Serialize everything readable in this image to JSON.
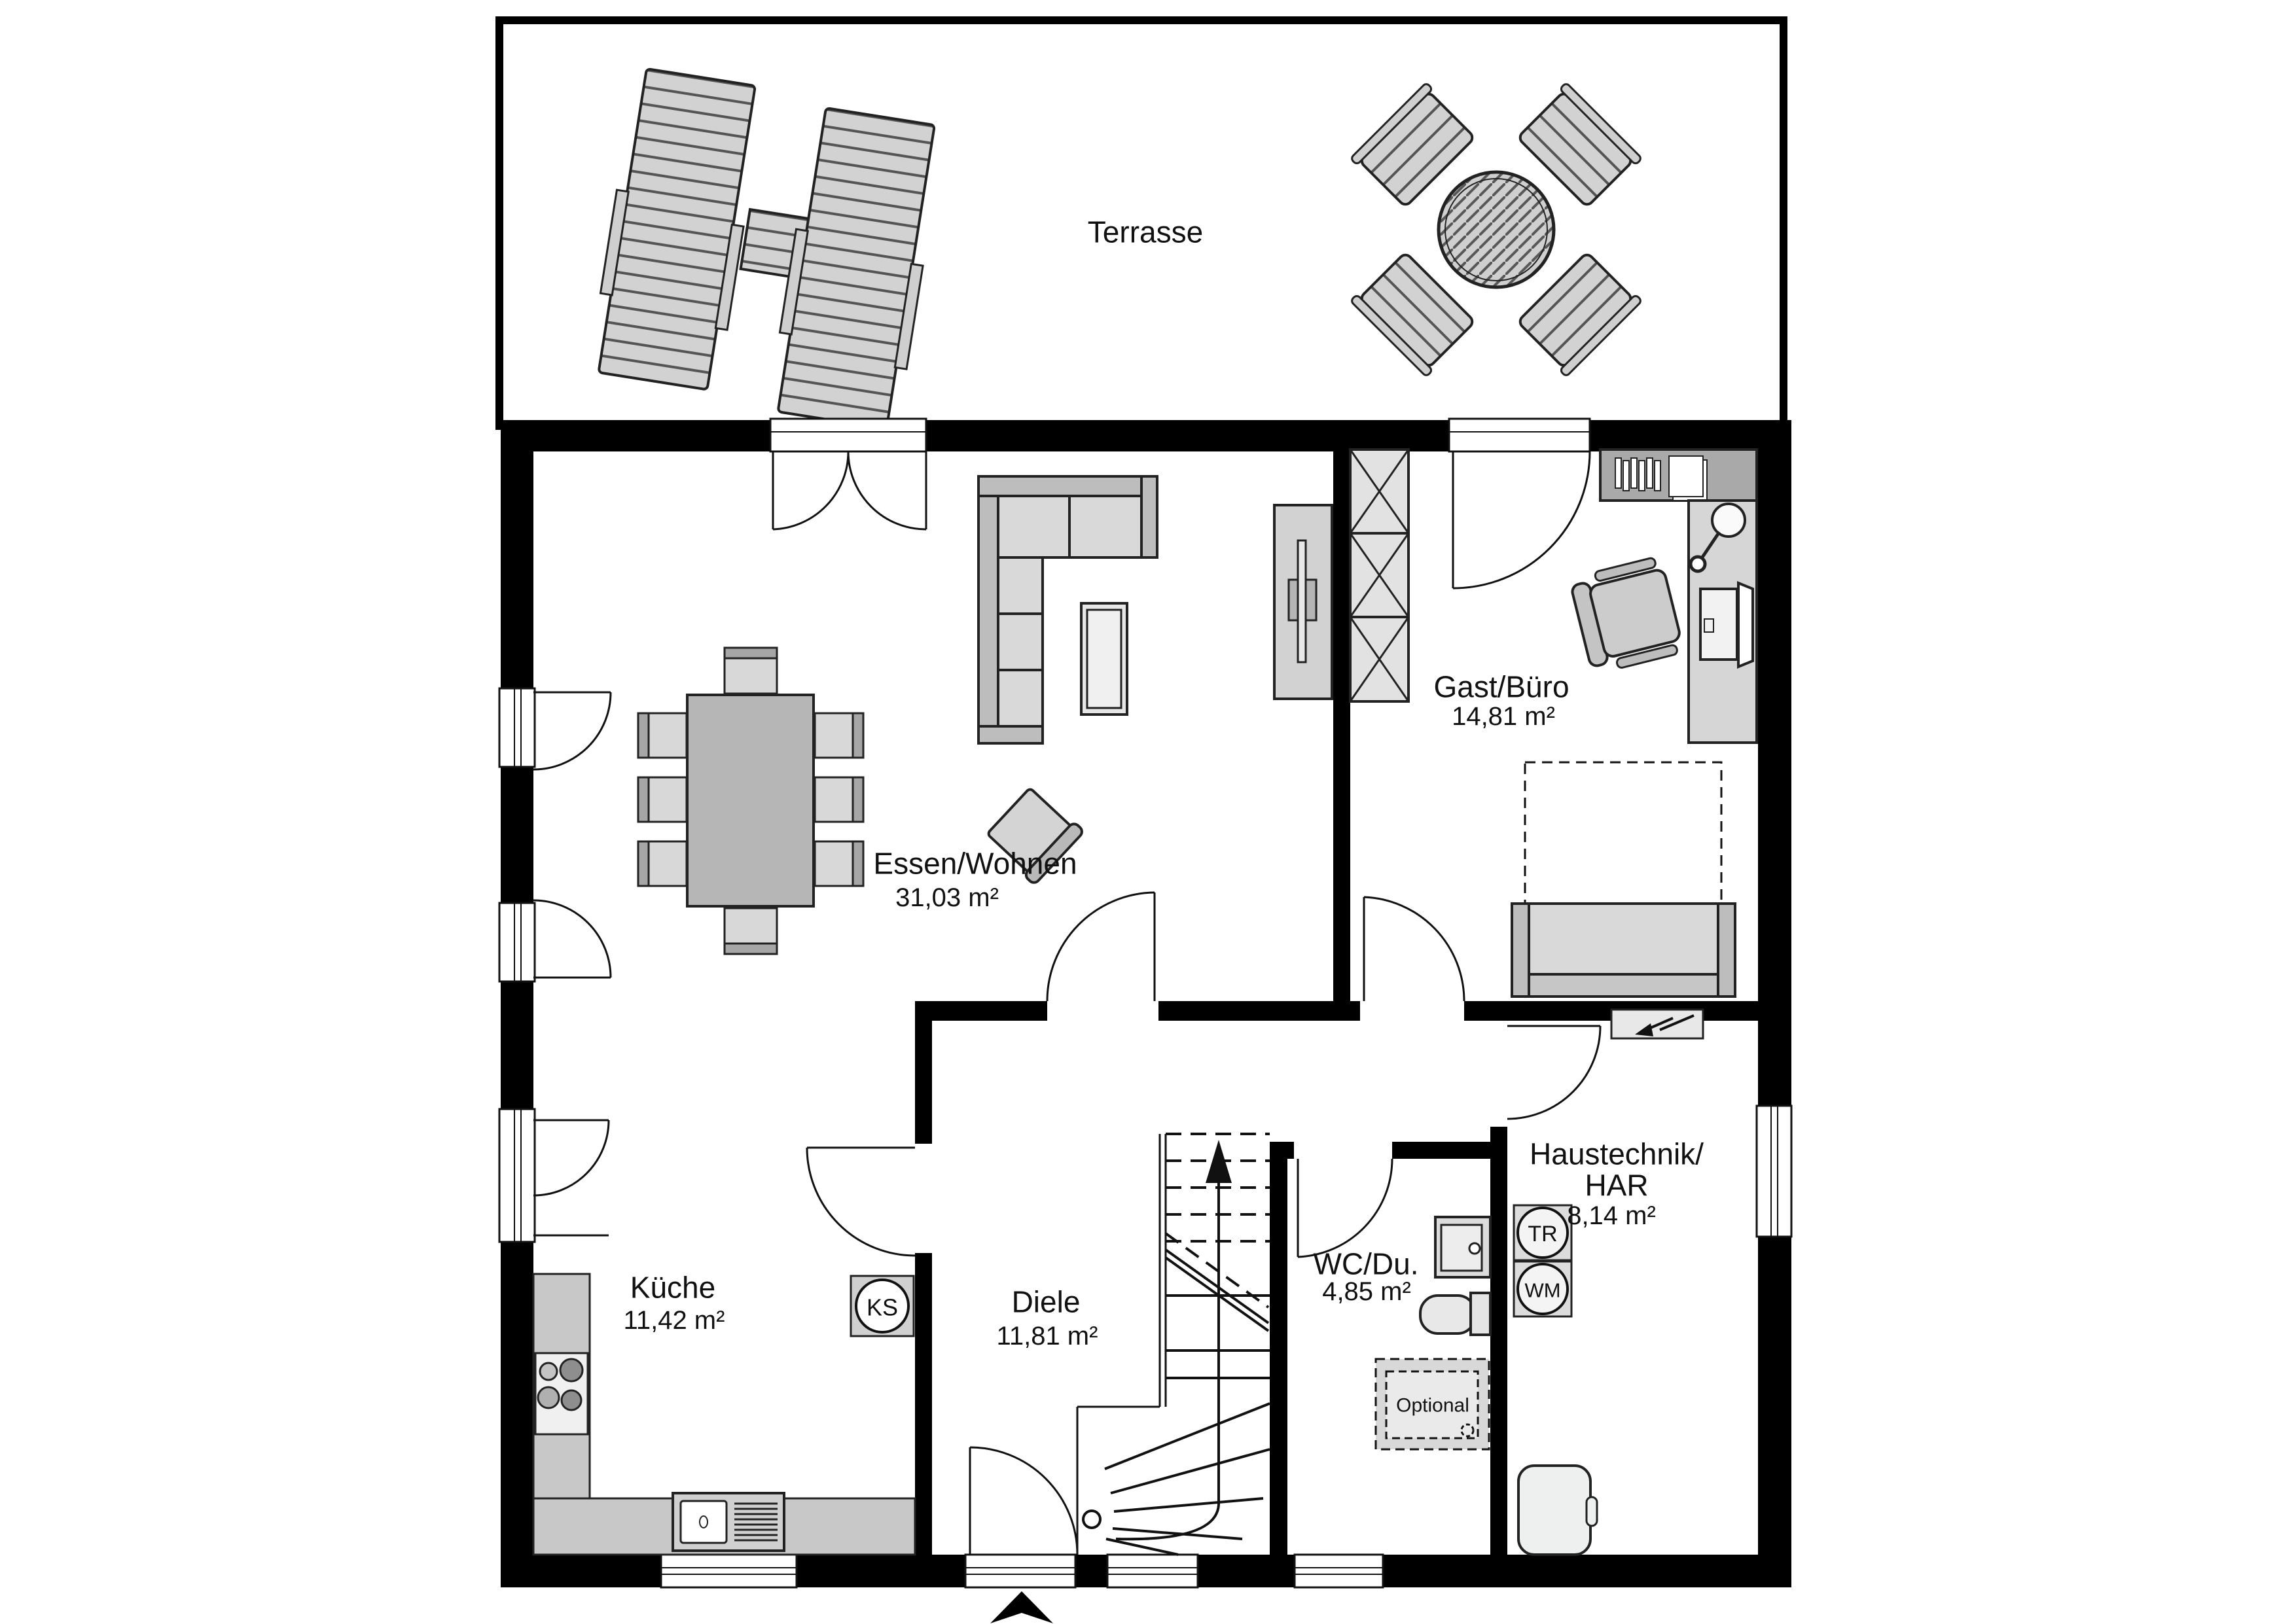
{
  "terrace": {
    "label": "Terrasse"
  },
  "rooms": {
    "living": {
      "name": "Essen/Wohnen",
      "area": "31,03 m²"
    },
    "guest": {
      "name": "Gast/Büro",
      "area": "14,81 m²"
    },
    "kitchen": {
      "name": "Küche",
      "area": "11,42 m²"
    },
    "hall": {
      "name": "Diele",
      "area": "11,81 m²"
    },
    "wc": {
      "name": "WC/Du.",
      "area": "4,85 m²"
    },
    "utility": {
      "name_line1": "Haustechnik/",
      "name_line2": "HAR",
      "area": "8,14 m²"
    }
  },
  "appliances": {
    "fridge": "KS",
    "dryer": "TR",
    "washer": "WM"
  },
  "annotations": {
    "optional_shower": "Optional"
  },
  "colors": {
    "wall": "#000000",
    "counter": "#c8c8c8",
    "furniture_light": "#d9d9d9",
    "furniture_mid": "#bdbdbd",
    "table": "#b6b6b6",
    "line": "#1a1a1a"
  }
}
